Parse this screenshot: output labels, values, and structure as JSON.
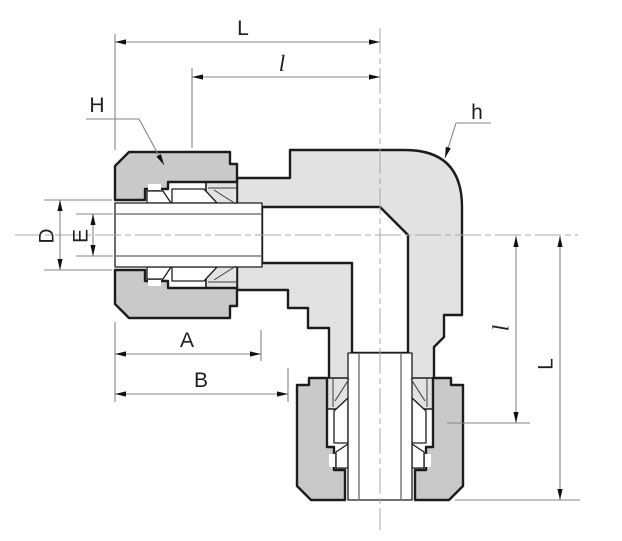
{
  "diagram": {
    "type": "technical-drawing",
    "subject": "90-degree elbow compression tube fitting cross-section with dimension callouts",
    "labels": {
      "length_overall_top": "L",
      "length_partial_top": "l",
      "nut_leader_left": "H",
      "body_leader_right": "h",
      "diameter_outer_left": "D",
      "diameter_inner_left": "E",
      "width_a_bottom": "A",
      "width_b_bottom": "B",
      "length_partial_right": "l",
      "length_overall_right": "L"
    },
    "colors": {
      "background": "#ffffff",
      "outline": "#1c1c1c",
      "nut_fill": "#c9c9c9",
      "body_fill": "#e2e2e2",
      "bore_fill": "#ffffff",
      "dimension_line": "#868686",
      "centerline": "#a8a8a8",
      "label_text": "#1f1f1f"
    }
  }
}
